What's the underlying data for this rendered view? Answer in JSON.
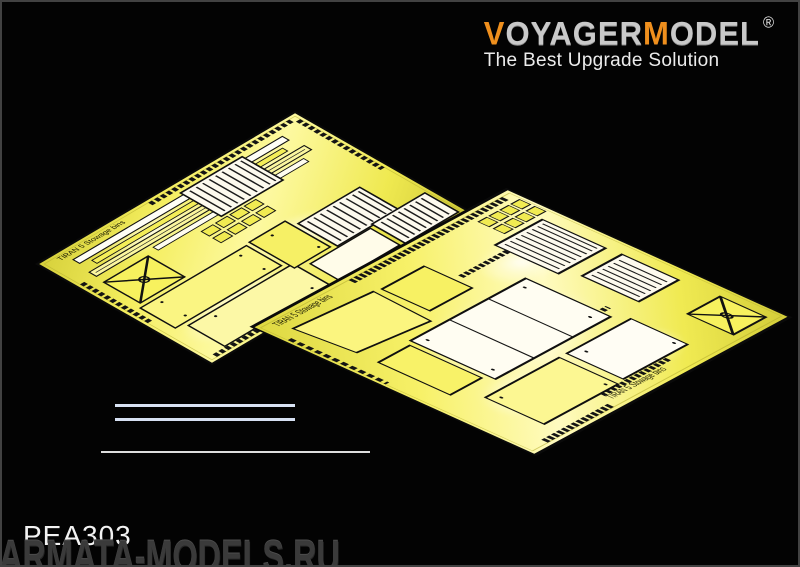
{
  "window": {
    "background_color": "#030303",
    "border_color": "#424242"
  },
  "logo": {
    "segments": [
      {
        "text": "V",
        "color": "#ef8f1d"
      },
      {
        "text": "OYAGER",
        "color": "#c9c9c9"
      },
      {
        "text": "M",
        "color": "#ef8f1d"
      },
      {
        "text": "ODEL",
        "color": "#c9c9c9"
      }
    ],
    "registered_mark": "®",
    "tagline": "The Best Upgrade Solution",
    "tagline_color": "#ececec"
  },
  "frets": {
    "base_color": "#f2ec55",
    "highlight_color": "#fffdf0",
    "etch_color": "#141414",
    "left_label": "TIRAN 5 Stowage bins",
    "right_label": "TIRAN 5 Stowage bins",
    "right_label_bottom": "TIRAN 5 Stowage bins"
  },
  "decor": {
    "short_lines_color": "#d9e3f4",
    "long_line_color": "#dedede"
  },
  "footer": {
    "product_code": "PEA303",
    "product_code_color": "#f2f2f2",
    "watermark": "ARMATA-MODELS.RU",
    "watermark_color": "#3a3a3a"
  }
}
